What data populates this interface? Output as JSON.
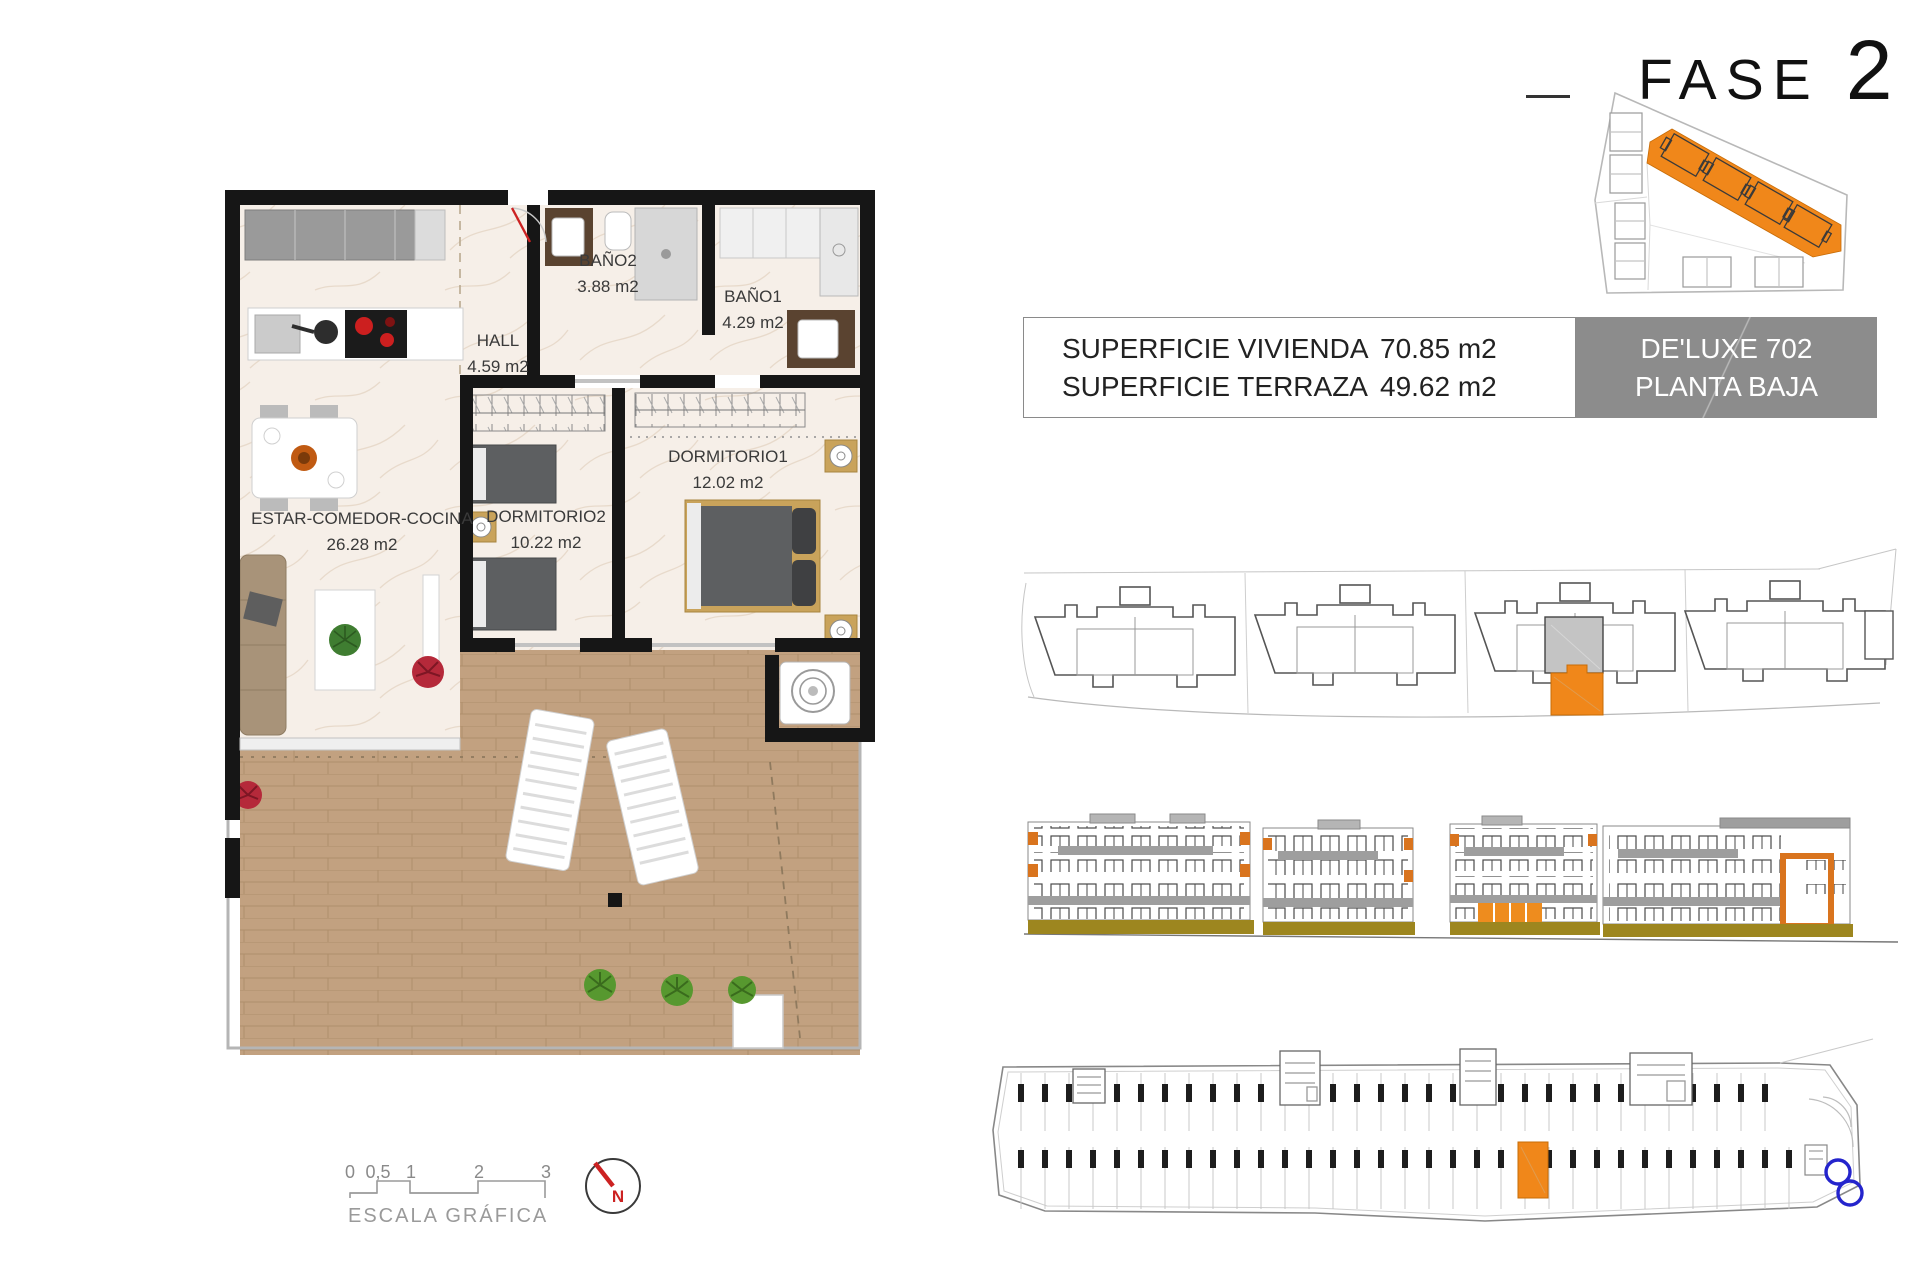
{
  "title": {
    "fase_label": "FASE",
    "fase_number": "2"
  },
  "info_panel": {
    "rows": [
      {
        "label": "SUPERFICIE VIVIENDA",
        "value": "70.85 m2"
      },
      {
        "label": "SUPERFICIE TERRAZA",
        "value": "49.62 m2"
      }
    ],
    "unit_box": {
      "line1": "DE'LUXE 702",
      "line2": "PLANTA BAJA"
    }
  },
  "floorplan": {
    "rooms": [
      {
        "name": "HALL",
        "area": "4.59 m2"
      },
      {
        "name": "BAÑO2",
        "area": "3.88 m2"
      },
      {
        "name": "BAÑO1",
        "area": "4.29 m2"
      },
      {
        "name": "DORMITORIO1",
        "area": "12.02 m2"
      },
      {
        "name": "DORMITORIO2",
        "area": "10.22 m2"
      },
      {
        "name": "ESTAR-COMEDOR-COCINA",
        "area": "26.28 m2"
      }
    ]
  },
  "scale_bar": {
    "ticks": [
      "0",
      "0,5",
      "1",
      "2",
      "3"
    ],
    "caption": "ESCALA GRÁFICA"
  },
  "compass": {
    "north_label": "N"
  },
  "colors": {
    "highlight_orange": "#F0871A",
    "elevation_accent_orange": "#D9741E",
    "unit_box_gray": "#8C8C8C",
    "facade_base_olive": "#9D861F",
    "balcony_gray": "#9E9E9E"
  }
}
